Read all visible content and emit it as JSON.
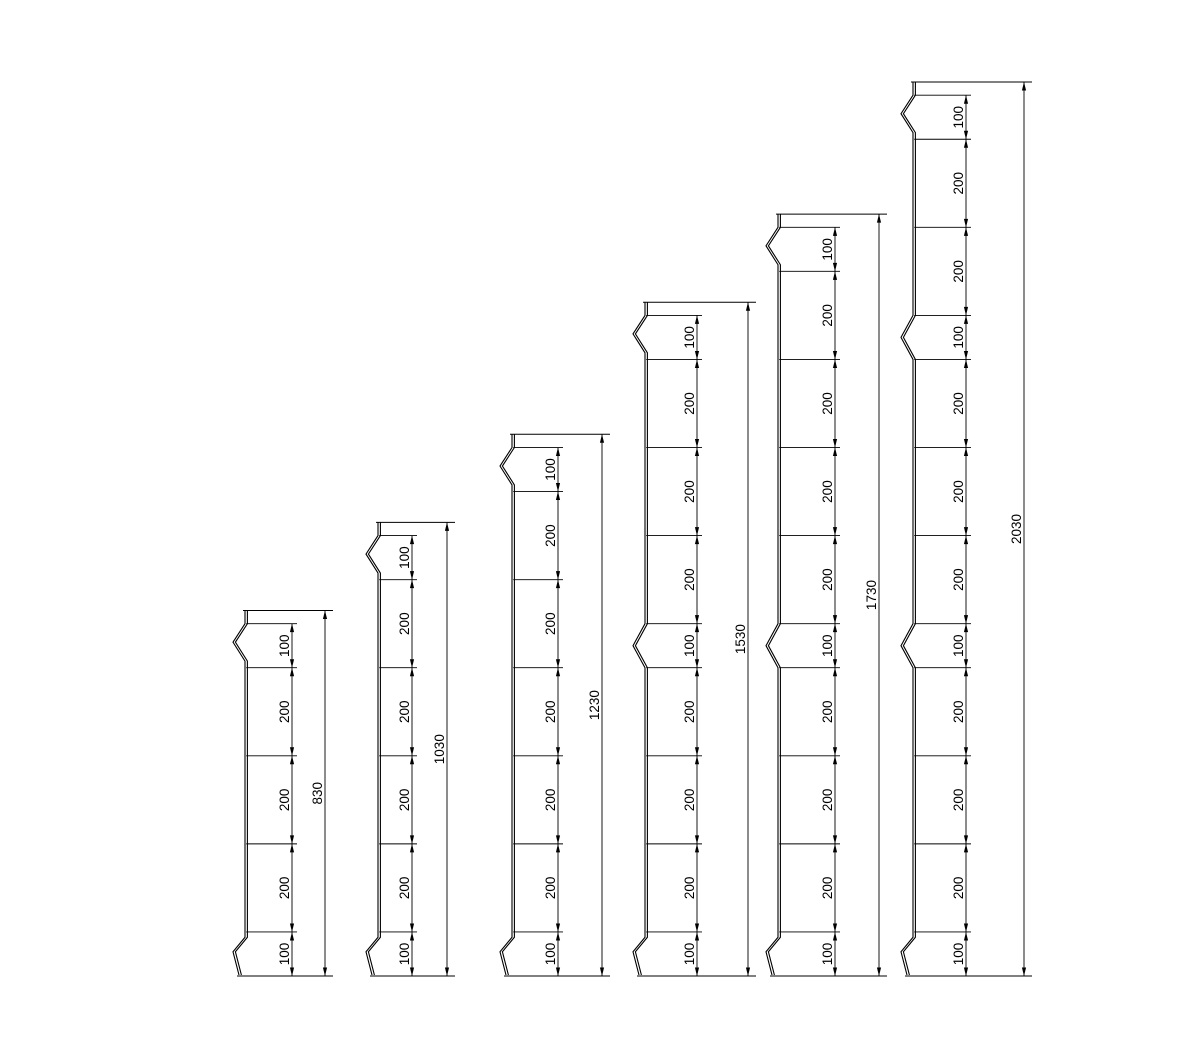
{
  "canvas": {
    "background_color": "#ffffff",
    "line_color": "#000000",
    "text_color": "#000000"
  },
  "drawings": [
    {
      "name": "profile-830",
      "total_label": "830",
      "total_mm": 830,
      "top_gap_mm": 30,
      "segments": [
        {
          "label": "100",
          "mm": 100,
          "notch": "top"
        },
        {
          "label": "200",
          "mm": 200,
          "notch": "none"
        },
        {
          "label": "200",
          "mm": 200,
          "notch": "none"
        },
        {
          "label": "200",
          "mm": 200,
          "notch": "none"
        },
        {
          "label": "100",
          "mm": 100,
          "notch": "bottom"
        }
      ]
    },
    {
      "name": "profile-1030",
      "total_label": "1030",
      "total_mm": 1030,
      "top_gap_mm": 30,
      "segments": [
        {
          "label": "100",
          "mm": 100,
          "notch": "top"
        },
        {
          "label": "200",
          "mm": 200,
          "notch": "none"
        },
        {
          "label": "200",
          "mm": 200,
          "notch": "none"
        },
        {
          "label": "200",
          "mm": 200,
          "notch": "none"
        },
        {
          "label": "200",
          "mm": 200,
          "notch": "none"
        },
        {
          "label": "100",
          "mm": 100,
          "notch": "bottom"
        }
      ]
    },
    {
      "name": "profile-1230",
      "total_label": "1230",
      "total_mm": 1230,
      "top_gap_mm": 30,
      "segments": [
        {
          "label": "100",
          "mm": 100,
          "notch": "top"
        },
        {
          "label": "200",
          "mm": 200,
          "notch": "none"
        },
        {
          "label": "200",
          "mm": 200,
          "notch": "none"
        },
        {
          "label": "200",
          "mm": 200,
          "notch": "none"
        },
        {
          "label": "200",
          "mm": 200,
          "notch": "none"
        },
        {
          "label": "200",
          "mm": 200,
          "notch": "none"
        },
        {
          "label": "100",
          "mm": 100,
          "notch": "bottom"
        }
      ]
    },
    {
      "name": "profile-1530",
      "total_label": "1530",
      "total_mm": 1530,
      "top_gap_mm": 30,
      "segments": [
        {
          "label": "100",
          "mm": 100,
          "notch": "top"
        },
        {
          "label": "200",
          "mm": 200,
          "notch": "none"
        },
        {
          "label": "200",
          "mm": 200,
          "notch": "none"
        },
        {
          "label": "200",
          "mm": 200,
          "notch": "none"
        },
        {
          "label": "100",
          "mm": 100,
          "notch": "mid"
        },
        {
          "label": "200",
          "mm": 200,
          "notch": "none"
        },
        {
          "label": "200",
          "mm": 200,
          "notch": "none"
        },
        {
          "label": "200",
          "mm": 200,
          "notch": "none"
        },
        {
          "label": "100",
          "mm": 100,
          "notch": "bottom"
        }
      ]
    },
    {
      "name": "profile-1730",
      "total_label": "1730",
      "total_mm": 1730,
      "top_gap_mm": 30,
      "segments": [
        {
          "label": "100",
          "mm": 100,
          "notch": "top"
        },
        {
          "label": "200",
          "mm": 200,
          "notch": "none"
        },
        {
          "label": "200",
          "mm": 200,
          "notch": "none"
        },
        {
          "label": "200",
          "mm": 200,
          "notch": "none"
        },
        {
          "label": "200",
          "mm": 200,
          "notch": "none"
        },
        {
          "label": "100",
          "mm": 100,
          "notch": "mid"
        },
        {
          "label": "200",
          "mm": 200,
          "notch": "none"
        },
        {
          "label": "200",
          "mm": 200,
          "notch": "none"
        },
        {
          "label": "200",
          "mm": 200,
          "notch": "none"
        },
        {
          "label": "100",
          "mm": 100,
          "notch": "bottom"
        }
      ]
    },
    {
      "name": "profile-2030",
      "total_label": "2030",
      "total_mm": 2030,
      "top_gap_mm": 30,
      "segments": [
        {
          "label": "100",
          "mm": 100,
          "notch": "top"
        },
        {
          "label": "200",
          "mm": 200,
          "notch": "none"
        },
        {
          "label": "200",
          "mm": 200,
          "notch": "none"
        },
        {
          "label": "100",
          "mm": 100,
          "notch": "mid"
        },
        {
          "label": "200",
          "mm": 200,
          "notch": "none"
        },
        {
          "label": "200",
          "mm": 200,
          "notch": "none"
        },
        {
          "label": "200",
          "mm": 200,
          "notch": "none"
        },
        {
          "label": "100",
          "mm": 100,
          "notch": "mid"
        },
        {
          "label": "200",
          "mm": 200,
          "notch": "none"
        },
        {
          "label": "200",
          "mm": 200,
          "notch": "none"
        },
        {
          "label": "200",
          "mm": 200,
          "notch": "none"
        },
        {
          "label": "100",
          "mm": 100,
          "notch": "bottom"
        }
      ]
    }
  ]
}
